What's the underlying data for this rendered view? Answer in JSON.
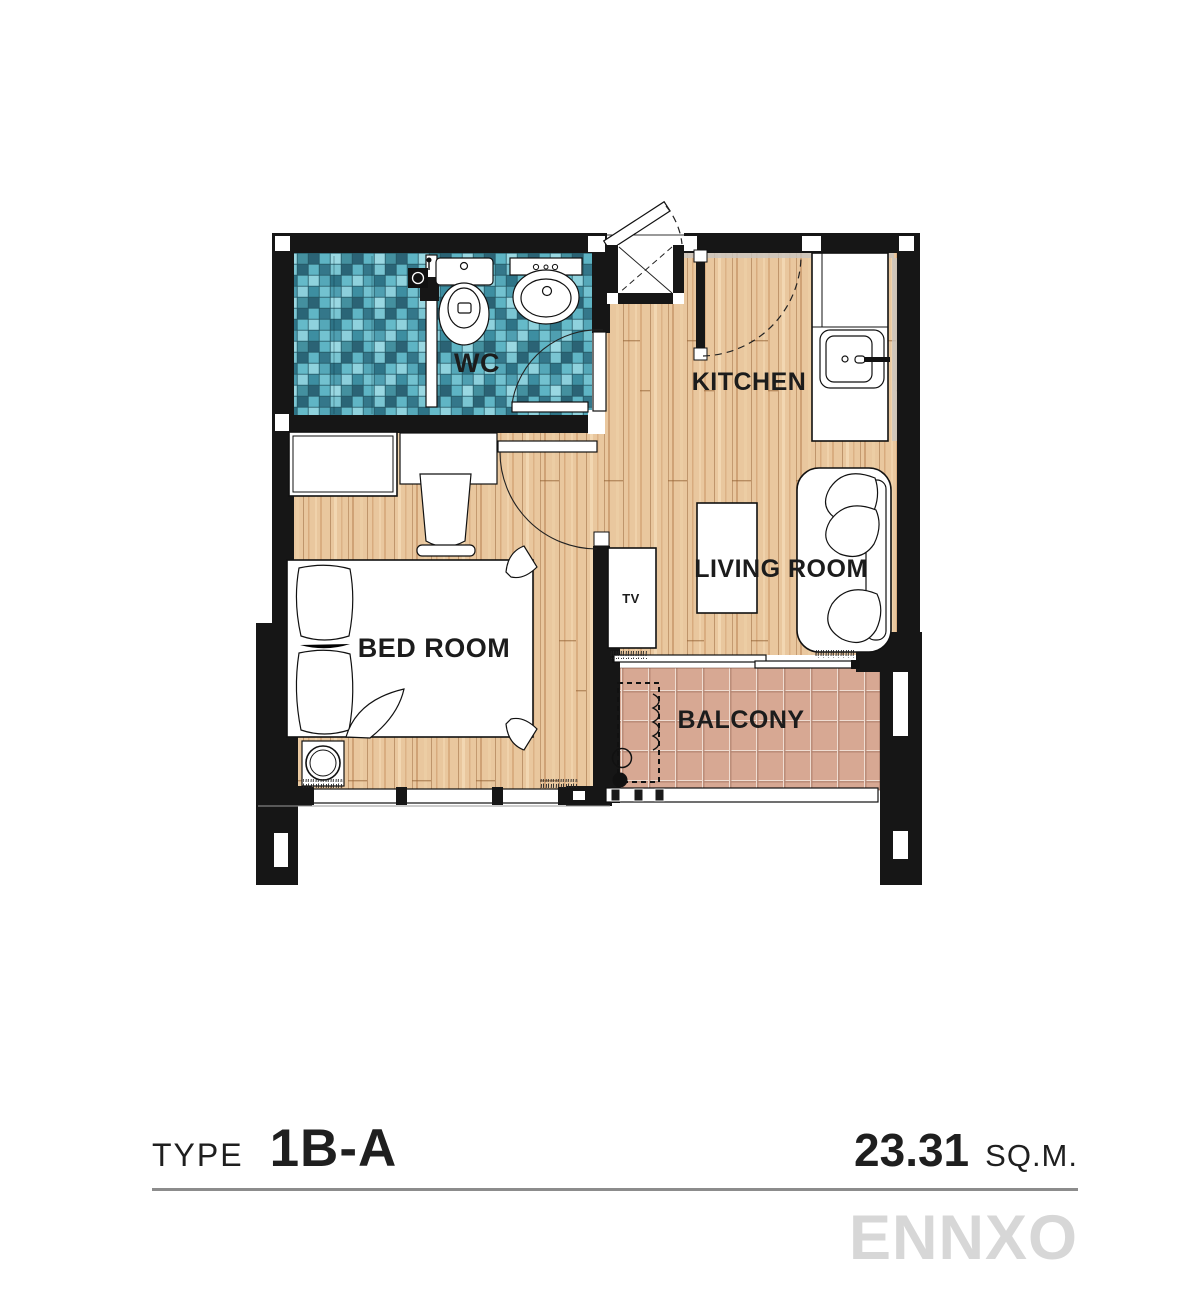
{
  "floorplan": {
    "rooms": [
      {
        "id": "wc",
        "label": "WC"
      },
      {
        "id": "kitchen",
        "label": "KITCHEN"
      },
      {
        "id": "living",
        "label": "LIVING ROOM"
      },
      {
        "id": "bedroom",
        "label": "BED ROOM"
      },
      {
        "id": "balcony",
        "label": "BALCONY"
      }
    ],
    "furniture": {
      "tv_label": "TV"
    }
  },
  "caption": {
    "type_label": "TYPE",
    "type_value": "1B-A",
    "area_value": "23.31",
    "area_unit": "SQ.M."
  },
  "watermark": "ENNXO",
  "colors": {
    "wall": "#161616",
    "tile_teal": "#57aebf",
    "wood": "#e8c49b",
    "balcony_tile": "#d7a893",
    "watermark_gray": "#d7d7d7",
    "caption_line": "#8c8c8c",
    "ink": "#1c1c1c"
  }
}
